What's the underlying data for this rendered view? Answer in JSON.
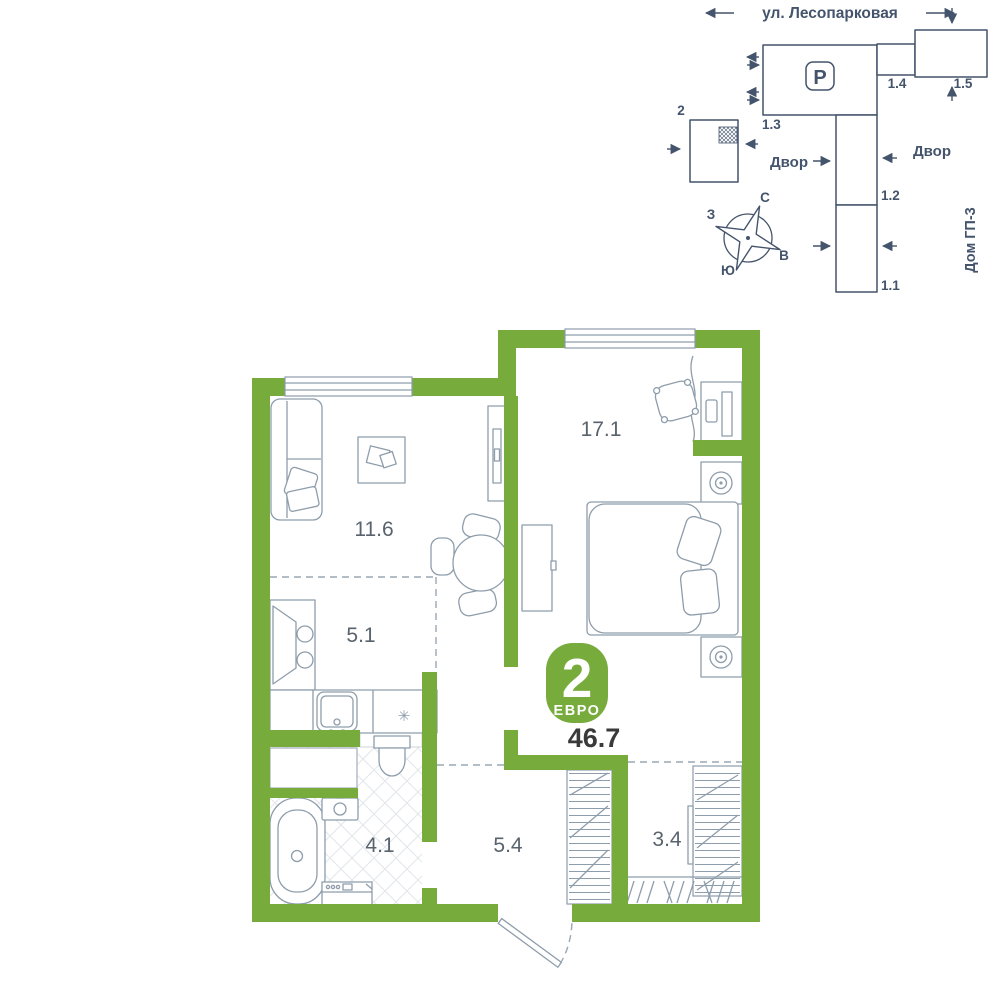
{
  "site_plan": {
    "street": "ул. Лесопарковая",
    "parking": "P",
    "yard_left": "Двор",
    "yard_right": "Двор",
    "house": "Дом ГП-3",
    "buildings": {
      "b2": "2",
      "b13": "1.3",
      "b14": "1.4",
      "b15": "1.5",
      "b12": "1.2",
      "b11": "1.1"
    },
    "compass": {
      "n": "С",
      "s": "Ю",
      "w": "З",
      "e": "В"
    }
  },
  "floor_plan": {
    "badge": {
      "number": "2",
      "label": "ЕВРО"
    },
    "total_area": "46.7",
    "rooms": [
      {
        "name": "bedroom",
        "area": "17.1"
      },
      {
        "name": "living-room",
        "area": "11.6"
      },
      {
        "name": "kitchen",
        "area": "5.1"
      },
      {
        "name": "bathroom",
        "area": "4.1"
      },
      {
        "name": "hallway",
        "area": "5.4"
      },
      {
        "name": "wardrobe",
        "area": "3.4"
      }
    ],
    "symbols": {
      "fridge": "✳"
    },
    "colors": {
      "wall_green": "#77ab3c",
      "site_line": "#44546c",
      "furniture_line": "#8e9dab",
      "area_text": "#3a3a3a"
    }
  }
}
